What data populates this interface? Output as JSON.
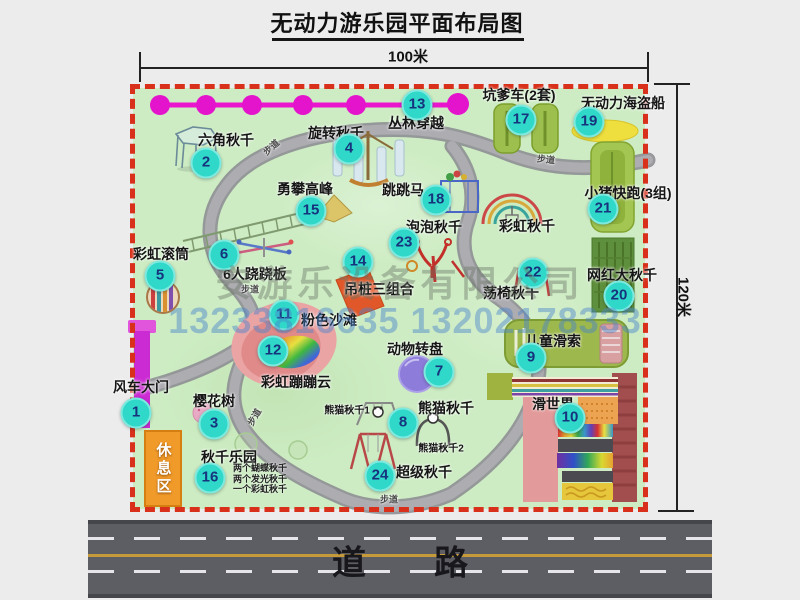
{
  "title": "无动力游乐园平面布局图",
  "dimensions": {
    "width_label": "100米",
    "height_label": "120米"
  },
  "road": {
    "label": "道　　路"
  },
  "rest_area": {
    "label": "休息区"
  },
  "watermark": {
    "company": "安游乐设备有限公司",
    "phones": "13233816635 13202178333"
  },
  "colors": {
    "badge": "#2fd8c8",
    "badge_text": "#16337d",
    "dashed_border": "#d8301a",
    "map_green": "#cdecc3",
    "road_gray": "#5d5d64",
    "zipline_magenta": "#e414cc",
    "rest_area_orange": "#f09a2a",
    "beach_pink": "#eaa4a4"
  },
  "markers": [
    {
      "n": "1",
      "label": "风车大门",
      "bx": 136,
      "by": 413,
      "lx": 141,
      "ly": 387
    },
    {
      "n": "2",
      "label": "六角秋千",
      "bx": 206,
      "by": 163,
      "lx": 226,
      "ly": 140
    },
    {
      "n": "3",
      "label": "樱花树",
      "bx": 214,
      "by": 424,
      "lx": 214,
      "ly": 401
    },
    {
      "n": "4",
      "label": "旋转秋千",
      "bx": 349,
      "by": 149,
      "lx": 336,
      "ly": 133
    },
    {
      "n": "5",
      "label": "彩虹滚筒",
      "bx": 160,
      "by": 276,
      "lx": 161,
      "ly": 254
    },
    {
      "n": "6",
      "label": "6人跷跷板",
      "bx": 224,
      "by": 255,
      "lx": 255,
      "ly": 274
    },
    {
      "n": "7",
      "label": "动物转盘",
      "bx": 439,
      "by": 372,
      "lx": 415,
      "ly": 349
    },
    {
      "n": "8",
      "label": "熊猫秋千",
      "bx": 403,
      "by": 423,
      "lx": 446,
      "ly": 408
    },
    {
      "n": "9",
      "label": "儿童滑索",
      "bx": 531,
      "by": 358,
      "lx": 553,
      "ly": 341
    },
    {
      "n": "10",
      "label": "滑世界",
      "bx": 570,
      "by": 418,
      "lx": 553,
      "ly": 404
    },
    {
      "n": "11",
      "label": "粉色沙滩",
      "bx": 284,
      "by": 315,
      "lx": 329,
      "ly": 320
    },
    {
      "n": "12",
      "label": "彩虹蹦蹦云",
      "bx": 273,
      "by": 351,
      "lx": 296,
      "ly": 382
    },
    {
      "n": "13",
      "label": "丛林穿越",
      "bx": 417,
      "by": 105,
      "lx": 416,
      "ly": 123
    },
    {
      "n": "14",
      "label": "吊桩三组合",
      "bx": 358,
      "by": 262,
      "lx": 379,
      "ly": 289
    },
    {
      "n": "15",
      "label": "勇攀高峰",
      "bx": 311,
      "by": 211,
      "lx": 305,
      "ly": 189
    },
    {
      "n": "16",
      "label": "秋千乐园",
      "bx": 210,
      "by": 478,
      "lx": 229,
      "ly": 457
    },
    {
      "n": "17",
      "label": "坑爹车(2套)",
      "bx": 521,
      "by": 120,
      "lx": 519,
      "ly": 95
    },
    {
      "n": "18",
      "label": "跳跳马",
      "bx": 436,
      "by": 200,
      "lx": 403,
      "ly": 190
    },
    {
      "n": "19",
      "label": "无动力海盗船",
      "bx": 589,
      "by": 122,
      "lx": 623,
      "ly": 103
    },
    {
      "n": "20",
      "label": "网红大秋千",
      "bx": 619,
      "by": 296,
      "lx": 622,
      "ly": 275
    },
    {
      "n": "21",
      "label": "小猪快跑(3组)",
      "bx": 603,
      "by": 209,
      "lx": 628,
      "ly": 193
    },
    {
      "n": "22",
      "label": "荡椅秋千",
      "bx": 533,
      "by": 273,
      "lx": 511,
      "ly": 293
    },
    {
      "n": "23",
      "label": "泡泡秋千",
      "bx": 404,
      "by": 243,
      "lx": 434,
      "ly": 227
    },
    {
      "n": "24",
      "label": "超级秋千",
      "bx": 380,
      "by": 476,
      "lx": 424,
      "ly": 472
    }
  ],
  "annotations": [
    {
      "text": "彩虹秋千",
      "x": 527,
      "y": 226,
      "size": 14
    },
    {
      "text": "熊猫秋千1",
      "x": 347,
      "y": 409,
      "size": 10
    },
    {
      "text": "熊猫秋千2",
      "x": 441,
      "y": 447,
      "size": 10
    }
  ],
  "path_labels": [
    {
      "text": "步道",
      "x": 271,
      "y": 147,
      "rot": -42
    },
    {
      "text": "步道",
      "x": 546,
      "y": 159,
      "rot": 6
    },
    {
      "text": "步道",
      "x": 250,
      "y": 289,
      "rot": 0
    },
    {
      "text": "步道",
      "x": 254,
      "y": 417,
      "rot": -60
    },
    {
      "text": "步道",
      "x": 389,
      "y": 499,
      "rot": 0
    }
  ],
  "swing_park_notes": [
    "两个蝴蝶秋千",
    "两个发光秋千",
    "一个彩虹秋千"
  ]
}
